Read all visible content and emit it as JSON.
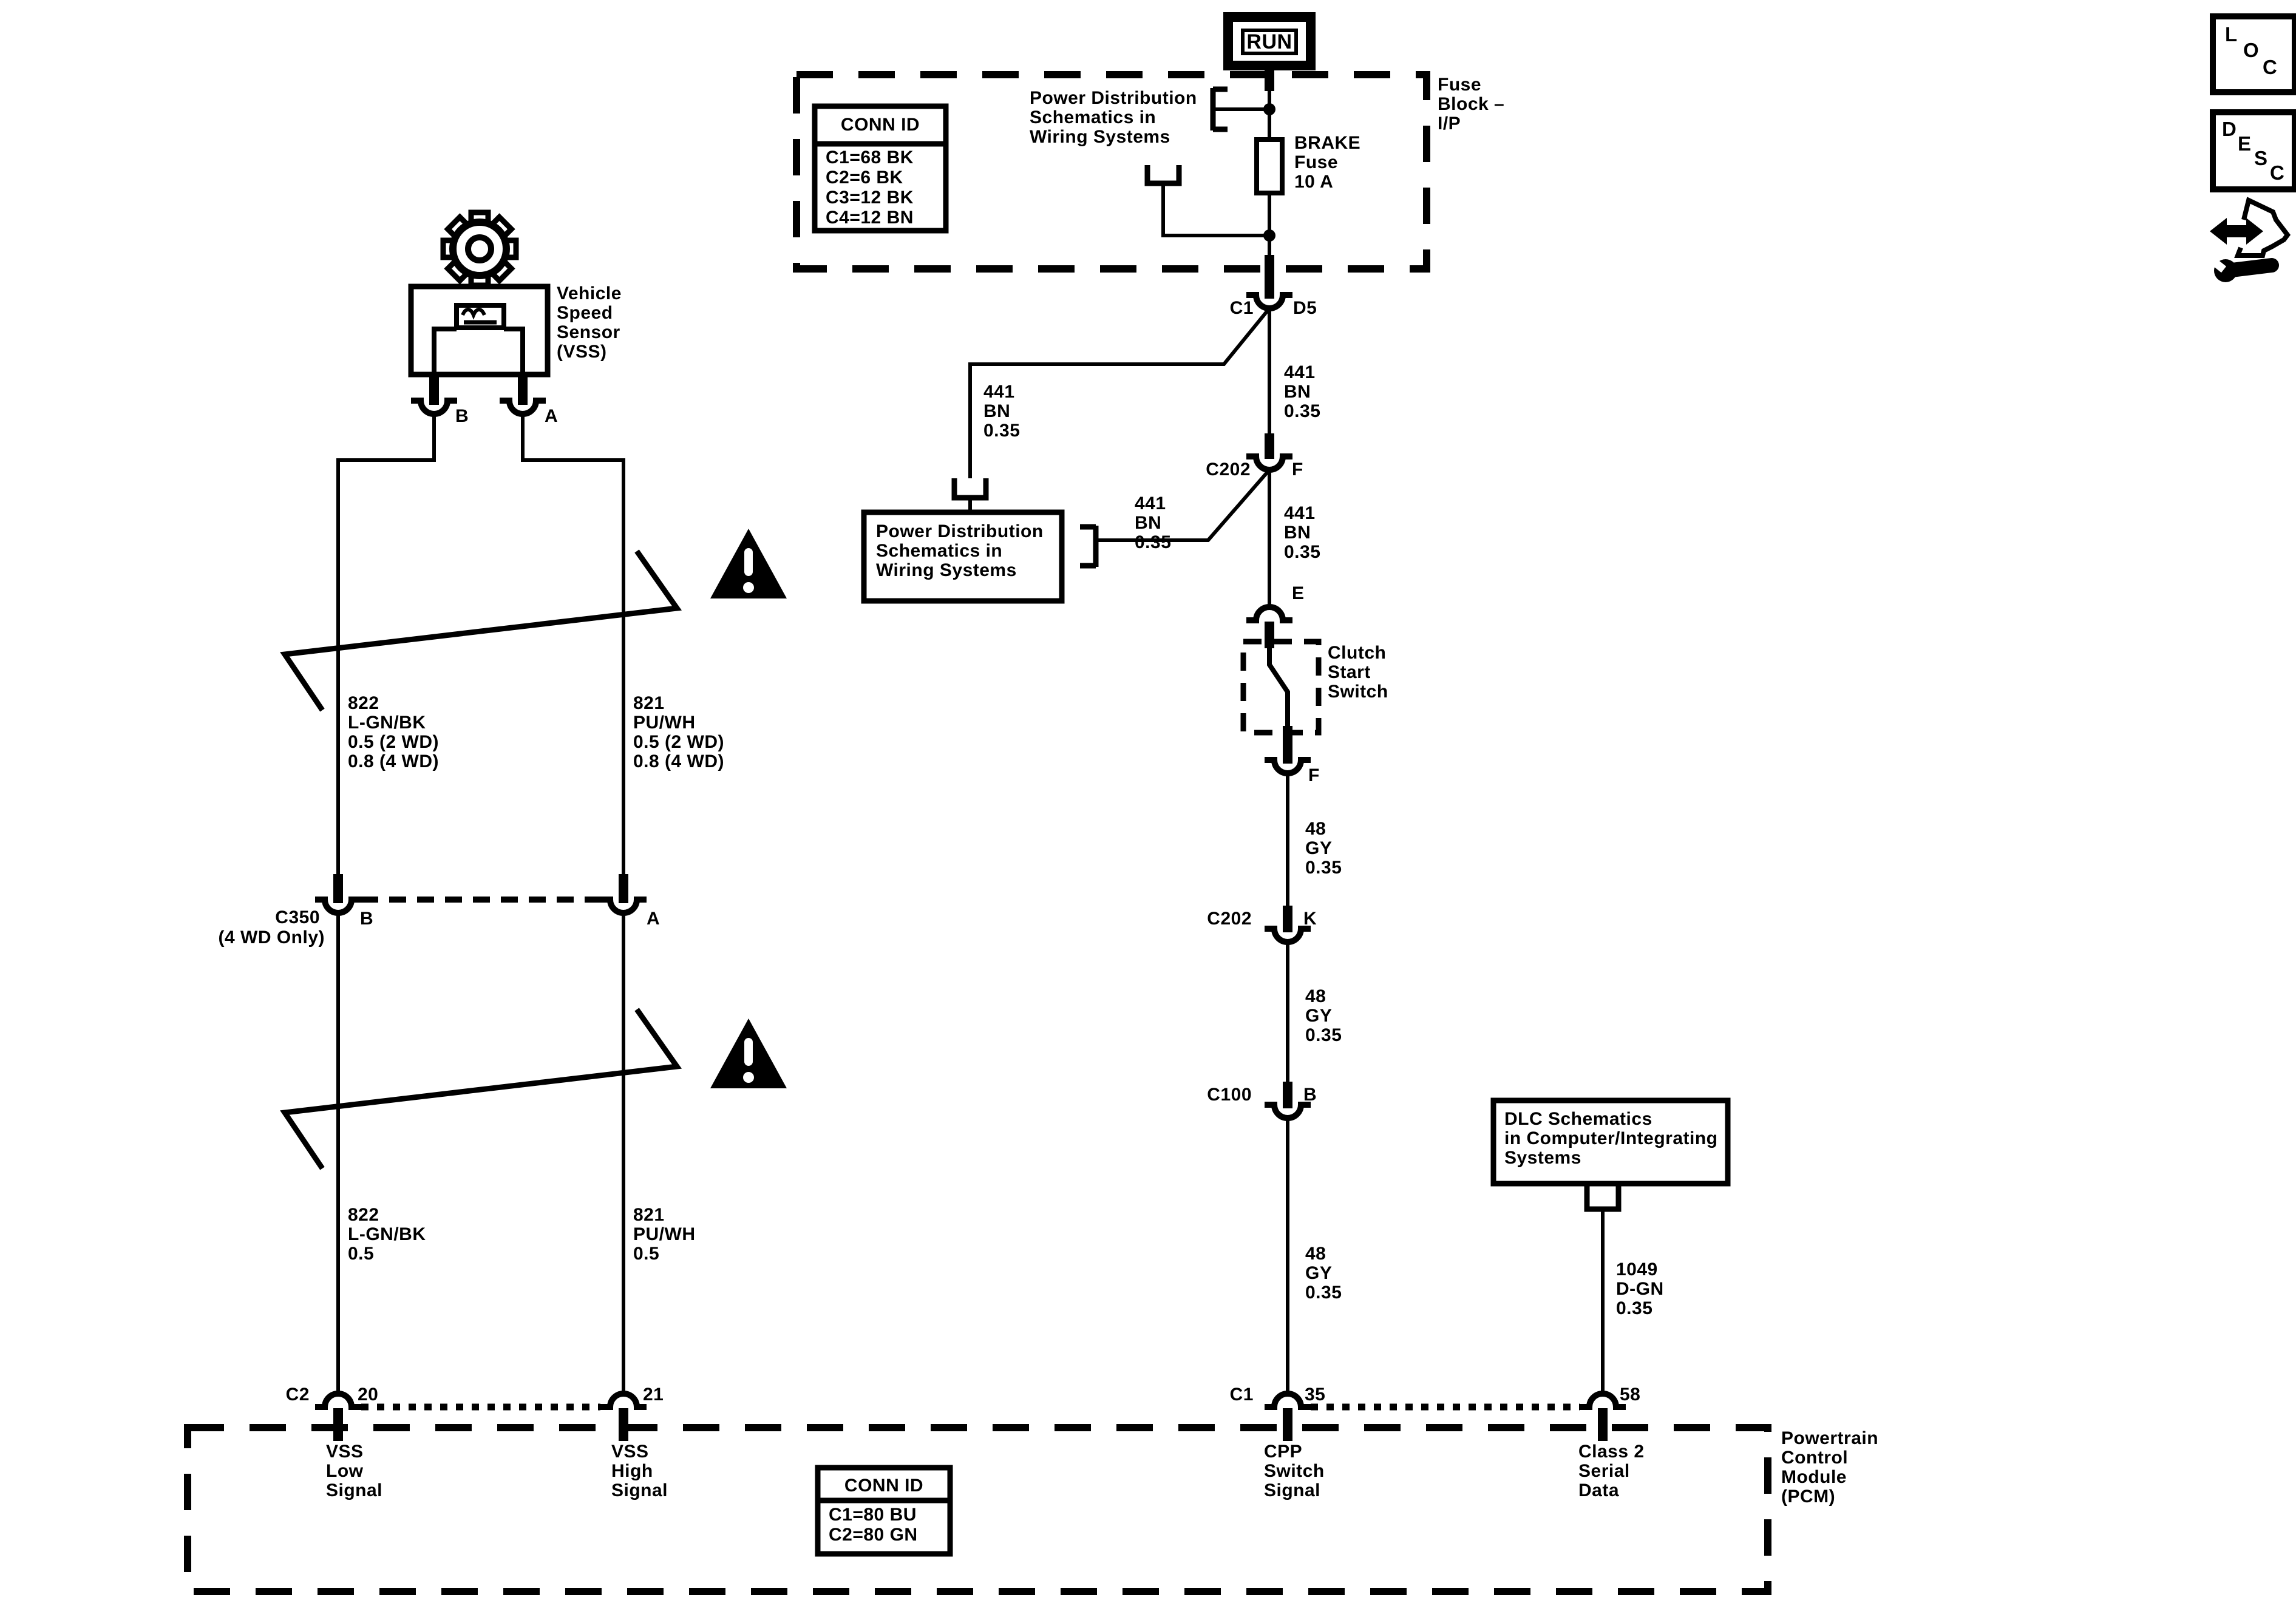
{
  "colors": {
    "ink": "#000000",
    "paper": "#ffffff"
  },
  "toolbar": {
    "loc_letters": [
      "L",
      "O",
      "C"
    ],
    "desc_letters": [
      "D",
      "E",
      "S",
      "C"
    ]
  },
  "ignition": {
    "run_label": "RUN"
  },
  "fuse_block": {
    "label": "Fuse\nBlock –\nI/P",
    "conn_id": {
      "title": "CONN ID",
      "rows": [
        "C1=68 BK",
        "C2=6 BK",
        "C3=12 BK",
        "C4=12 BN"
      ]
    },
    "power_dist_note": "Power Distribution\nSchematics in\nWiring Systems",
    "fuse_label": "BRAKE\nFuse\n10 A"
  },
  "vss": {
    "label": "Vehicle\nSpeed\nSensor\n(VSS)",
    "pin_b": "B",
    "pin_a": "A"
  },
  "c350": {
    "name": "C350",
    "note": "(4 WD Only)",
    "pin_b": "B",
    "pin_a": "A"
  },
  "power_dist_box": {
    "label": "Power Distribution\nSchematics in\nWiring Systems"
  },
  "dlc_box": {
    "label": "DLC Schematics\nin Computer/Integrating\nSystems"
  },
  "clutch": {
    "label": "Clutch\nStart\nSwitch",
    "pin_in": "E",
    "pin_out": "F"
  },
  "connectors": {
    "c1d5": {
      "conn": "C1",
      "pin": "D5"
    },
    "c202f": {
      "conn": "C202",
      "pin": "F"
    },
    "c202k": {
      "conn": "C202",
      "pin": "K"
    },
    "c100b": {
      "conn": "C100",
      "pin": "B"
    }
  },
  "wires": [
    {
      "name": "822-upper",
      "text": "822\nL-GN/BK\n0.5 (2 WD)\n0.8 (4 WD)"
    },
    {
      "name": "821-upper",
      "text": "821\nPU/WH\n0.5 (2 WD)\n0.8 (4 WD)"
    },
    {
      "name": "822-lower",
      "text": "822\nL-GN/BK\n0.5"
    },
    {
      "name": "821-lower",
      "text": "821\nPU/WH\n0.5"
    },
    {
      "name": "441-main-upper",
      "text": "441\nBN\n0.35"
    },
    {
      "name": "441-left-branch",
      "text": "441\nBN\n0.35"
    },
    {
      "name": "441-box-branch",
      "text": "441\nBN\n0.35"
    },
    {
      "name": "441-main-lower",
      "text": "441\nBN\n0.35"
    },
    {
      "name": "48-upper",
      "text": "48\nGY\n0.35"
    },
    {
      "name": "48-middle",
      "text": "48\nGY\n0.35"
    },
    {
      "name": "48-lower",
      "text": "48\nGY\n0.35"
    },
    {
      "name": "1049",
      "text": "1049\nD-GN\n0.35"
    }
  ],
  "pcm": {
    "label": "Powertrain\nControl\nModule\n(PCM)",
    "pins": {
      "c2": "C2",
      "p20": "20",
      "p21": "21",
      "c1": "C1",
      "p35": "35",
      "p58": "58"
    },
    "signals": [
      "VSS\nLow\nSignal",
      "VSS\nHigh\nSignal",
      "CPP\nSwitch\nSignal",
      "Class 2\nSerial\nData"
    ],
    "conn_id": {
      "title": "CONN ID",
      "rows": [
        "C1=80 BU",
        "C2=80 GN"
      ]
    }
  }
}
